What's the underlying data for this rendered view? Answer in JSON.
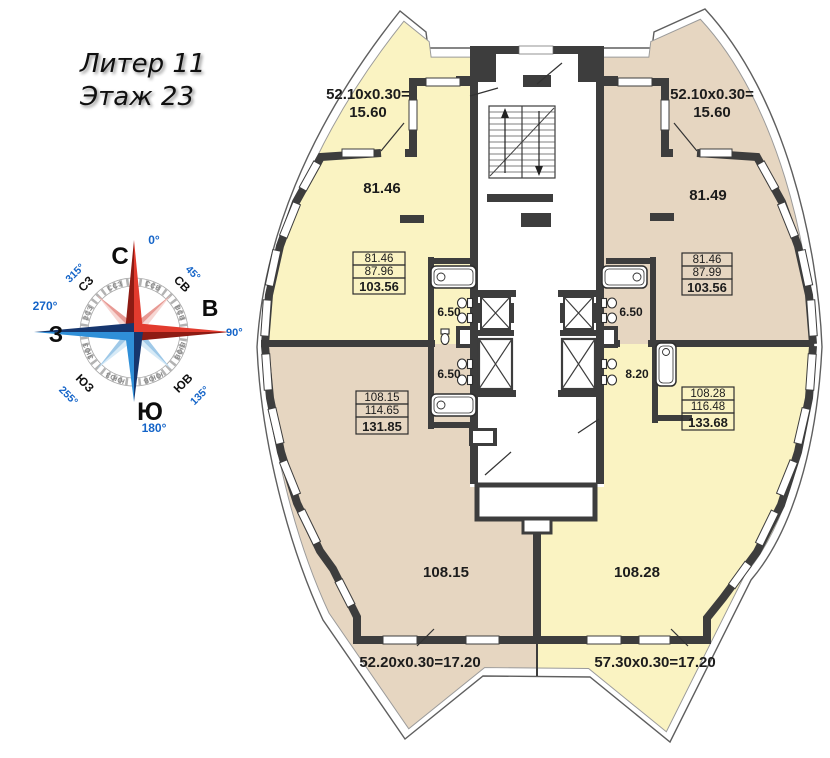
{
  "title": {
    "line1": "Литер 11",
    "line2": "Этаж 23"
  },
  "compass": {
    "cardinal": {
      "north": "С",
      "east": "В",
      "south": "Ю",
      "west": "З"
    },
    "degrees": {
      "n": "0°",
      "ne": "45°",
      "e": "90°",
      "se": "135°",
      "s": "180°",
      "sw": "255°",
      "w": "270°",
      "nw": "315°"
    },
    "intercardinal": {
      "ne": "СВ",
      "se": "ЮВ",
      "sw": "ЮЗ",
      "nw": "СЗ"
    },
    "minor": {
      "nne": "ССВ",
      "ene": "ВСВ",
      "ese": "ВЮВ",
      "sse": "ЮЮВ",
      "ssw": "ЮЮЗ",
      "wsw": "ЗЮЗ",
      "wnw": "ЗСЗ",
      "nnw": "ССЗ"
    }
  },
  "apartments": {
    "top_left": {
      "balcony_calc_line1": "52.10x0.30=",
      "balcony_calc_line2": "15.60",
      "room_area": "81.46",
      "area_living": "81.46",
      "area_total": "87.96",
      "area_with_balcony": "103.56",
      "bathroom_area": "6.50"
    },
    "top_right": {
      "balcony_calc_line1": "52.10x0.30=",
      "balcony_calc_line2": "15.60",
      "room_area": "81.49",
      "area_living": "81.46",
      "area_total": "87.99",
      "area_with_balcony": "103.56",
      "bathroom_area": "6.50"
    },
    "bottom_left": {
      "room_area": "108.15",
      "area_living": "108.15",
      "area_total": "114.65",
      "area_with_balcony": "131.85",
      "bathroom_area": "6.50",
      "balcony_calc": "52.20x0.30=17.20"
    },
    "bottom_right": {
      "room_area": "108.28",
      "area_living": "108.28",
      "area_total": "116.48",
      "area_with_balcony": "133.68",
      "bathroom_area": "8.20",
      "balcony_calc": "57.30x0.30=17.20"
    }
  },
  "colors": {
    "floor_yellow": "#faf3c2",
    "floor_tan": "#e6d6c1",
    "wall": "#3d3d3d",
    "compass_red_dark": "#8e1b13",
    "compass_red": "#e23b2e",
    "compass_blue_dark": "#16366e",
    "compass_blue": "#2f8fd8"
  }
}
